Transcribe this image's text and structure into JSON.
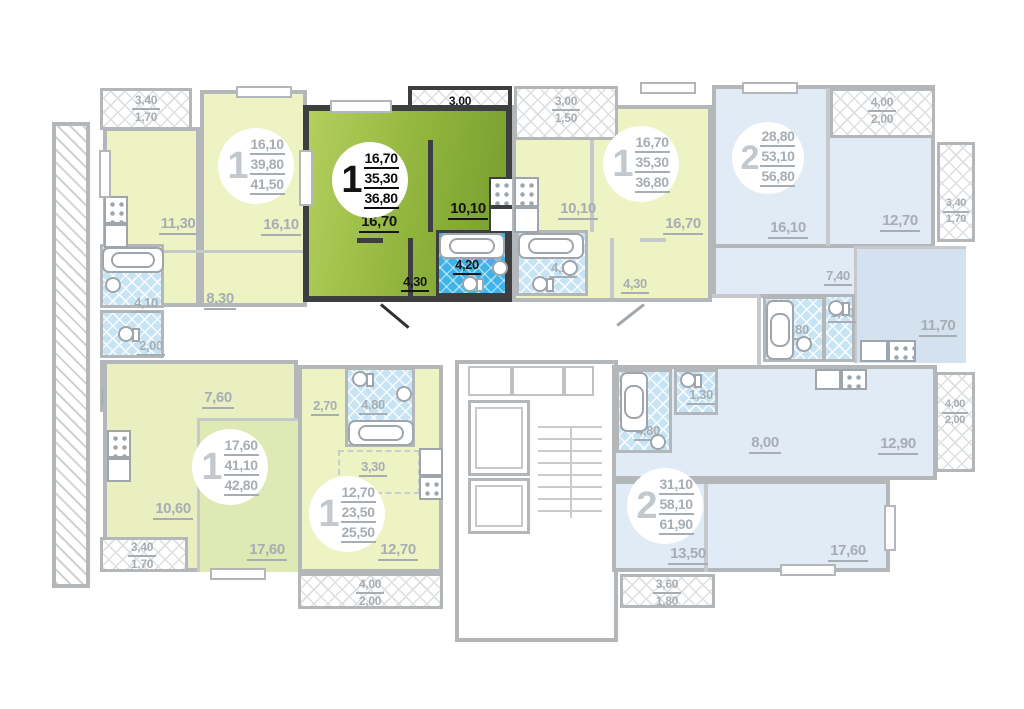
{
  "badges": {
    "a": {
      "num": "1",
      "l1": "16,10",
      "l2": "39,80",
      "l3": "41,50"
    },
    "b": {
      "num": "1",
      "l1": "16,70",
      "l2": "35,30",
      "l3": "36,80"
    },
    "c": {
      "num": "1",
      "l1": "16,70",
      "l2": "35,30",
      "l3": "36,80"
    },
    "d": {
      "num": "2",
      "l1": "28,80",
      "l2": "53,10",
      "l3": "56,80"
    },
    "e": {
      "num": "1",
      "l1": "17,60",
      "l2": "41,10",
      "l3": "42,80"
    },
    "f": {
      "num": "1",
      "l1": "12,70",
      "l2": "23,50",
      "l3": "25,50"
    },
    "g": {
      "num": "2",
      "l1": "31,10",
      "l2": "58,10",
      "l3": "61,90"
    }
  },
  "rooms": {
    "a_kitchen": "11,30",
    "a_room": "16,10",
    "a_hall": "8,30",
    "a_bath": "4,10",
    "a_balc_len": "3,40",
    "a_balc_area": "1,70",
    "b_room": "16,70",
    "b_kitchen": "10,10",
    "b_bath": "4,20",
    "b_hall": "4,30",
    "b_balc_len": "3,00",
    "b_balc_area": "1,50",
    "c_room": "16,70",
    "c_kitchen": "10,10",
    "c_bath": "4,20",
    "c_hall": "4,30",
    "c_balc_len": "3,00",
    "c_balc_area": "1,50",
    "d_room1": "16,10",
    "d_room2": "12,70",
    "d_hall": "7,40",
    "d_wc": "1,40",
    "d_bath": "3,80",
    "d_kitchen": "11,70",
    "d_balc_top_len": "4,00",
    "d_balc_top_area": "2,00",
    "d_balc_right_len": "3,40",
    "d_balc_right_area": "1,70",
    "e_wc": "2,00",
    "e_bath": "3,30",
    "e_hall": "7,60",
    "e_kitchen": "10,60",
    "e_room": "17,60",
    "e_balc_len": "3,40",
    "e_balc_area": "1,70",
    "f_hall": "2,70",
    "f_bath": "4,80",
    "f_kitchen": "3,30",
    "f_room": "12,70",
    "f_balc_len": "4,00",
    "f_balc_area": "2,00",
    "g_bath": "4,80",
    "g_wc": "1,30",
    "g_hall": "8,00",
    "g_kitchen": "12,90",
    "g_room1": "13,50",
    "g_room2": "17,60",
    "g_balc_bottom_len": "3,60",
    "g_balc_bottom_area": "1,80",
    "g_balc_right_len": "4,00",
    "g_balc_right_area": "2,00"
  },
  "colors": {
    "highlight_green": "#8fb33c",
    "pale_yellow": "#eef3c4",
    "pale_green": "#e9efc0",
    "pale_blue": "#e1ebf6",
    "tile_blue": "#c7e4f4",
    "tile_highlight": "#3fb2e8",
    "wall_gray": "#b4b7ba",
    "wall_dark": "#3c3e40",
    "label_gray": "#a6adb3",
    "label_dark": "#151515"
  }
}
